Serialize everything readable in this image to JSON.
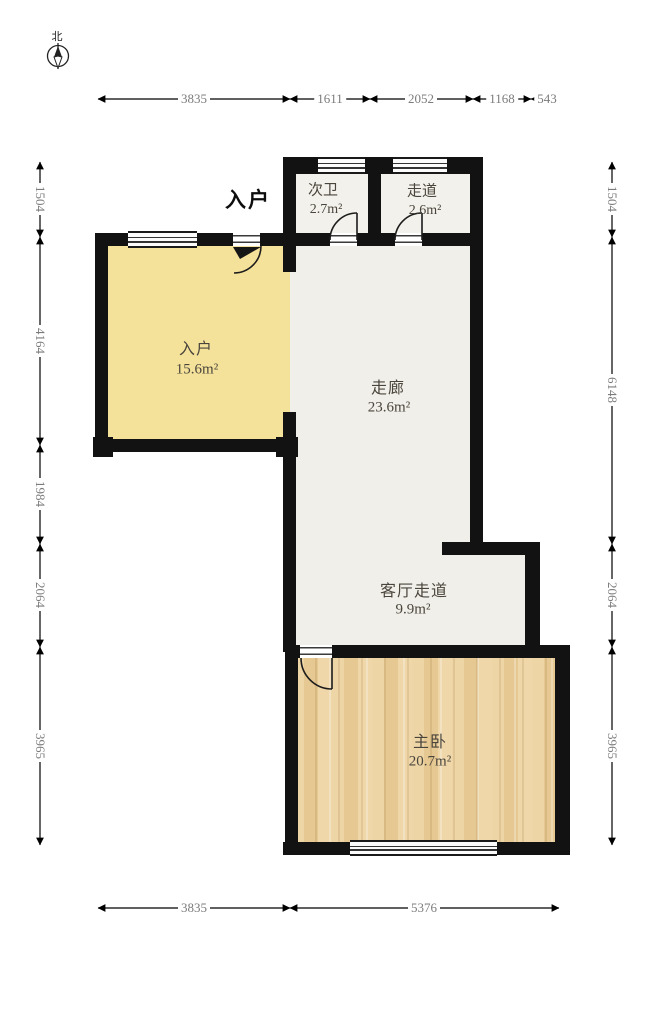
{
  "compass": {
    "north": "北"
  },
  "entry_marker": "入户",
  "rooms": [
    {
      "name": "次卫",
      "area": "2.7m²"
    },
    {
      "name": "走道",
      "area": "2.6m²"
    },
    {
      "name": "入户",
      "area": "15.6m²"
    },
    {
      "name": "走廊",
      "area": "23.6m²"
    },
    {
      "name": "客厅走道",
      "area": "9.9m²"
    },
    {
      "name": "主卧",
      "area": "20.7m²"
    }
  ],
  "dims": {
    "top": [
      "3835",
      "1611",
      "2052",
      "1168",
      "543"
    ],
    "bottom": [
      "3835",
      "5376"
    ],
    "left": [
      "1504",
      "4164",
      "1984",
      "2064",
      "3965"
    ],
    "right": [
      "1504",
      "6148",
      "2064",
      "3965"
    ]
  },
  "colors": {
    "wall": "#121212",
    "entry_room_fill": "#f5e29a",
    "corridor_fill": "#f1efe9",
    "bedroom_wood_fill": "#ecd2a0",
    "dimension_text": "#7c7c7c",
    "room_label_text": "#49453c"
  }
}
